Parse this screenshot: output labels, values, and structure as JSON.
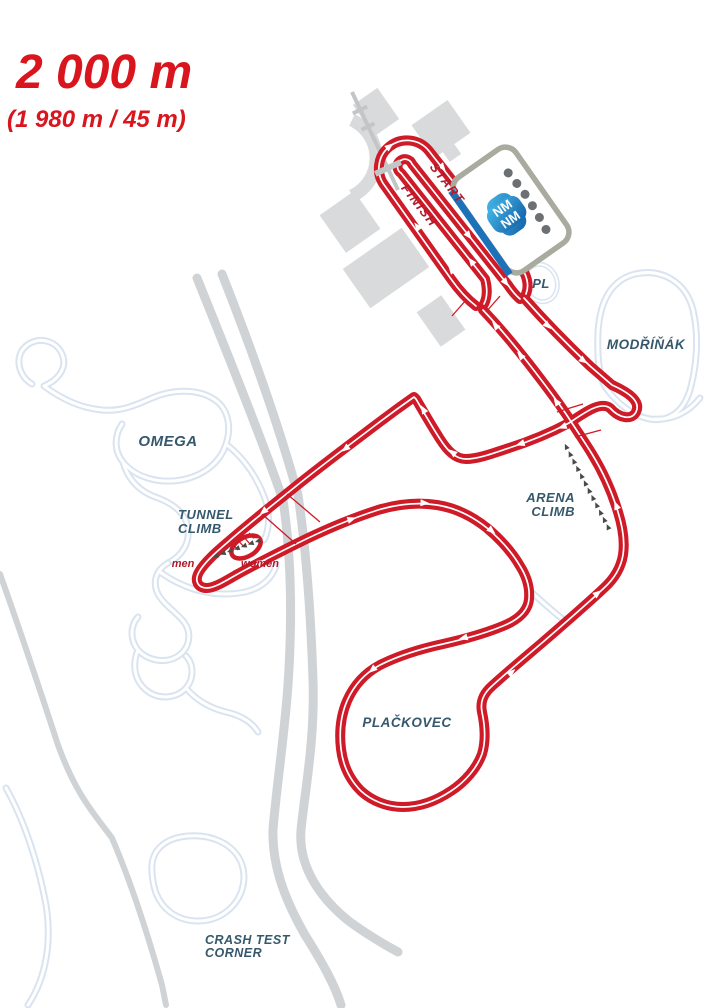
{
  "header": {
    "title": "2 000 m",
    "subtitle": "(1 980 m / 45 m)"
  },
  "labels": {
    "start": "START",
    "finish": "FINISH",
    "pl": "PL",
    "modrinak": "MODŘÍŇÁK",
    "omega": "OMEGA",
    "tunnel_climb": [
      "TUNNEL",
      "CLIMB"
    ],
    "arena_climb": [
      "ARENA",
      "CLIMB"
    ],
    "plackovec": "PLAČKOVEC",
    "crash_test_corner": [
      "CRASH TEST",
      "CORNER"
    ],
    "men": "men",
    "women": "women"
  },
  "stadium_logo": [
    "NM",
    "NM"
  ],
  "colors": {
    "trackRed": "#cf1a28",
    "accentRed": "#d9151e",
    "startFinishRed": "#b5182a",
    "labelNavy": "#35586d",
    "sideTrackBlue": "#d9e4f0",
    "roadGrey": "#d0d3d6",
    "buildingGrey": "#d8dadb",
    "stadiumBorder": "#a8ab9e",
    "stadiumBlue": "#1d71b8",
    "logoBlueLight": "#45b8e8",
    "logoBlueDark": "#1a6cb0",
    "dotGrey": "#6d7072",
    "chevronGrey": "#4a4a4a"
  }
}
